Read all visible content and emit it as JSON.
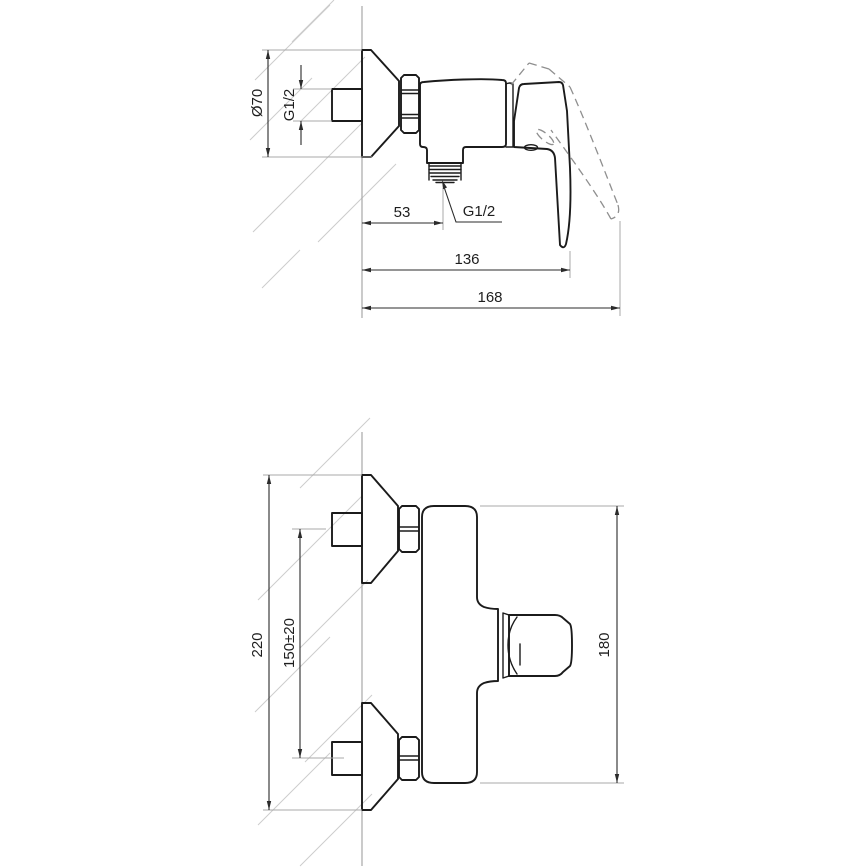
{
  "page": {
    "background": "#ffffff"
  },
  "drawing": {
    "subject": "Wall-mounted single-lever shower mixer — dimensioned two-view technical drawing",
    "colors": {
      "outline": "#1b1b1b",
      "dimension": "#2b2b2b",
      "extension": "#a8a8a8",
      "hatch": "#cccccc",
      "phantom": "#8f8f8f",
      "background": "#ffffff"
    },
    "side_view": {
      "name": "side view (handle down, phantom handle raised)",
      "dims": {
        "escutcheon_diameter": "Ø70",
        "inlet_thread": "G1/2",
        "wall_to_outlet_center": "53",
        "outlet_thread": "G1/2",
        "wall_to_lever_tip": "136",
        "wall_to_lever_tip_raised": "168"
      }
    },
    "front_view": {
      "name": "front view (wall connections)",
      "dims": {
        "overall_height": "220",
        "connection_spacing": "150±20",
        "body_height": "180"
      }
    }
  }
}
